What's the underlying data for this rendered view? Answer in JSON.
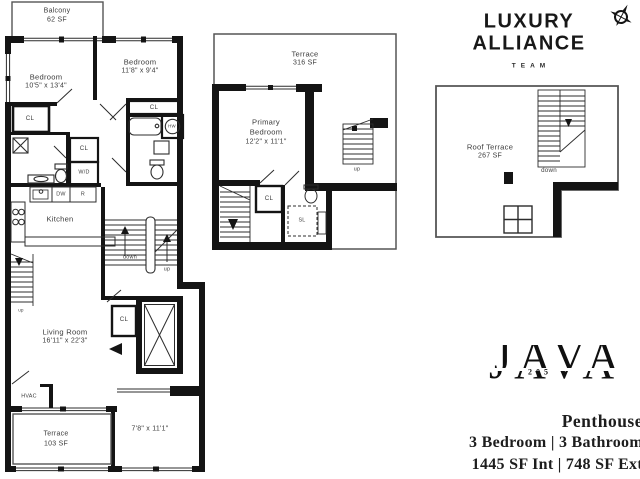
{
  "branding": {
    "luxury_line1": "LUXURY",
    "luxury_line2": "ALLIANCE",
    "luxury_sub": "TEAM",
    "java_word": "JAVA",
    "java_number": "205",
    "unit_type": "Penthouse",
    "spec_line1": "3 Bedroom | 3 Bathroom",
    "spec_line2": "1445 SF Int | 748 SF Ext"
  },
  "colors": {
    "wall": "#141414",
    "thin_line": "#2c2c2c",
    "label_text": "#3c3c3c"
  },
  "floor1": {
    "balcony": {
      "name": "Balcony",
      "area": "62 SF"
    },
    "bedroom_left": {
      "name": "Bedroom",
      "dims": "10'5\" x 13'4\""
    },
    "bedroom_right": {
      "name": "Bedroom",
      "dims": "11'8\" x 9'4\""
    },
    "kitchen": {
      "name": "Kitchen"
    },
    "living_room": {
      "name": "Living Room",
      "dims": "16'11\" x 22'3\""
    },
    "terrace": {
      "name": "Terrace",
      "area": "103 SF"
    },
    "flex_dims": "7'8\" x 11'1\"",
    "hvac": "HVAC",
    "labels": {
      "cl": "CL",
      "wd": "W/D",
      "dw": "DW",
      "r": "R",
      "hw": "HW",
      "up": "up",
      "down": "down"
    }
  },
  "floor2": {
    "terrace": {
      "name": "Terrace",
      "area": "316 SF"
    },
    "primary_bedroom": {
      "line1": "Primary",
      "line2": "Bedroom",
      "dims": "12'2\" x 11'1\""
    },
    "labels": {
      "cl": "CL",
      "sl": "SL",
      "up": "up"
    }
  },
  "roof": {
    "terrace": {
      "name": "Roof Terrace",
      "area": "267 SF"
    },
    "labels": {
      "down": "down"
    }
  }
}
